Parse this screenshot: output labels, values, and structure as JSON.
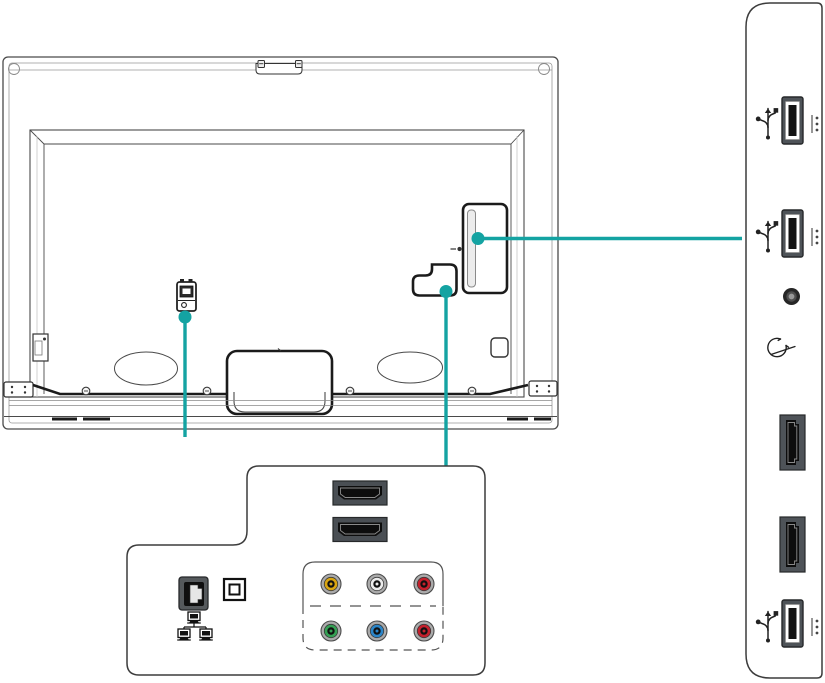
{
  "colors": {
    "accent": "#14A3A2",
    "outline": "#3C3C3C",
    "thick_line": "#1B1B1B",
    "port_body": "#4E5358",
    "port_slot": "#131313",
    "ring_gray": "#ABABAB"
  },
  "tv_back": {
    "power_port": {
      "icon": "power-connector-icon"
    },
    "side_port_cover": {
      "icon": "side-port-cover"
    },
    "bottom_port_cover": {
      "icon": "bottom-port-cover"
    },
    "stand_mount": {
      "icon": "stand-mount"
    }
  },
  "side_panel": {
    "ports": [
      {
        "id": "usb-1",
        "icon": "usb-icon"
      },
      {
        "id": "usb-2",
        "icon": "usb-icon"
      },
      {
        "id": "headphone-jack",
        "icon": "headphone-icon"
      },
      {
        "id": "hdmi-1",
        "icon": "hdmi-port-icon"
      },
      {
        "id": "hdmi-2",
        "icon": "hdmi-port-icon"
      },
      {
        "id": "usb-3",
        "icon": "usb-icon"
      }
    ]
  },
  "bottom_panel": {
    "hdmi_ports": 2,
    "ethernet": {
      "icon": "ethernet-port-icon",
      "label_icon": "lan-network-icon"
    },
    "optical": {
      "icon": "optical-audio-port-icon"
    },
    "av": {
      "composite": [
        {
          "name": "composite-video",
          "color": "#D9A511"
        },
        {
          "name": "audio-left",
          "color": "#ECECEC"
        },
        {
          "name": "audio-right",
          "color": "#C4202C"
        }
      ],
      "component": [
        {
          "name": "component-y",
          "color": "#35A054"
        },
        {
          "name": "component-pb",
          "color": "#2B85C8"
        },
        {
          "name": "component-pr",
          "color": "#C4202C"
        }
      ]
    }
  }
}
